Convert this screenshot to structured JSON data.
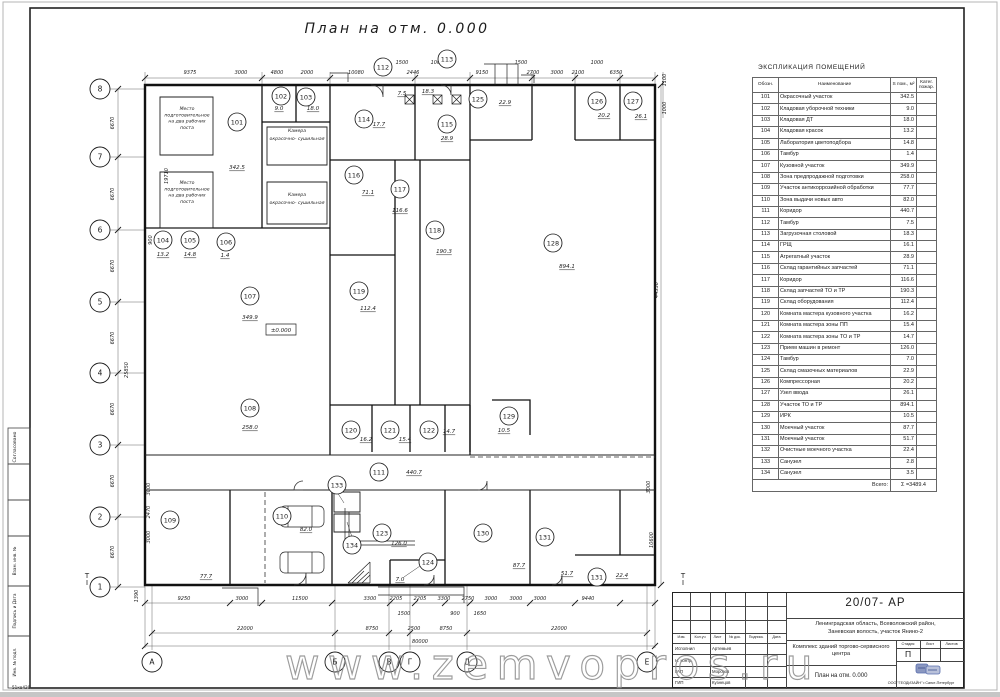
{
  "sheet": {
    "watermark": "www.zemvopros.ru",
    "corner_note": "51кв420"
  },
  "side_labels": {
    "approved": "Согласовано",
    "boxes": [
      "Взам. инв. №",
      "Подпись и Дата",
      "Инв. № подл."
    ]
  },
  "plan": {
    "title": "План на отм.  0.000",
    "level_mark": "±0.000",
    "axes": {
      "left": [
        [
          "8",
          89
        ],
        [
          "7",
          157
        ],
        [
          "6",
          230
        ],
        [
          "5",
          302
        ],
        [
          "4",
          373
        ],
        [
          "3",
          445
        ],
        [
          "2",
          517
        ],
        [
          "1",
          587
        ]
      ],
      "bottom": [
        [
          "А",
          152
        ],
        [
          "Б",
          335
        ],
        [
          "В",
          389
        ],
        [
          "Г",
          410
        ],
        [
          "Д",
          467
        ],
        [
          "Е",
          647
        ]
      ]
    },
    "dims": [
      [
        "9375",
        190,
        74,
        0
      ],
      [
        "3000",
        241,
        74,
        0
      ],
      [
        "4800",
        277,
        74,
        0
      ],
      [
        "2000",
        307,
        74,
        0
      ],
      [
        "10080",
        356,
        74,
        0
      ],
      [
        "2446",
        413,
        74,
        0
      ],
      [
        "9150",
        482,
        74,
        0
      ],
      [
        "2700",
        533,
        74,
        0
      ],
      [
        "3000",
        557,
        74,
        0
      ],
      [
        "2100",
        578,
        74,
        0
      ],
      [
        "6350",
        616,
        74,
        0
      ],
      [
        "1500",
        402,
        64,
        0
      ],
      [
        "1000",
        437,
        64,
        0
      ],
      [
        "1500",
        521,
        64,
        0
      ],
      [
        "1000",
        597,
        64,
        0
      ],
      [
        "9250",
        184,
        600,
        0
      ],
      [
        "3000",
        242,
        600,
        0
      ],
      [
        "11500",
        300,
        600,
        0
      ],
      [
        "3300",
        370,
        600,
        0
      ],
      [
        "2205",
        396,
        600,
        0
      ],
      [
        "2205",
        420,
        600,
        0
      ],
      [
        "3300",
        444,
        600,
        0
      ],
      [
        "2750",
        468,
        600,
        0
      ],
      [
        "3000",
        491,
        600,
        0
      ],
      [
        "3000",
        516,
        600,
        0
      ],
      [
        "3000",
        540,
        600,
        0
      ],
      [
        "9440",
        588,
        600,
        0
      ],
      [
        "1500",
        404,
        615,
        0
      ],
      [
        "900",
        455,
        615,
        0
      ],
      [
        "1650",
        480,
        615,
        0
      ],
      [
        "22000",
        245,
        630,
        0
      ],
      [
        "8750",
        372,
        630,
        0
      ],
      [
        "2500",
        414,
        630,
        0
      ],
      [
        "8750",
        446,
        630,
        0
      ],
      [
        "22000",
        559,
        630,
        0
      ],
      [
        "80000",
        420,
        643,
        0
      ],
      [
        "6670",
        114,
        123,
        1
      ],
      [
        "6670",
        114,
        194,
        1
      ],
      [
        "6670",
        114,
        266,
        1
      ],
      [
        "6670",
        114,
        338,
        1
      ],
      [
        "6670",
        114,
        409,
        1
      ],
      [
        "6670",
        114,
        481,
        1
      ],
      [
        "6670",
        114,
        552,
        1
      ],
      [
        "19710",
        168,
        176,
        1
      ],
      [
        "900",
        152,
        240,
        1
      ],
      [
        "25850",
        128,
        370,
        1
      ],
      [
        "3000",
        150,
        489,
        1
      ],
      [
        "2470",
        150,
        512,
        1
      ],
      [
        "3000",
        150,
        537,
        1
      ],
      [
        "1390",
        138,
        596,
        1
      ],
      [
        "1100",
        666,
        80,
        1
      ],
      [
        "1000",
        666,
        108,
        1
      ],
      [
        "44330",
        658,
        290,
        1
      ],
      [
        "3000",
        650,
        487,
        1
      ],
      [
        "10600",
        653,
        540,
        1
      ]
    ],
    "rooms": [
      [
        "101",
        237,
        122,
        "342.5",
        237,
        169
      ],
      [
        "102",
        281,
        96,
        "9.0",
        279,
        110
      ],
      [
        "103",
        306,
        97,
        "18.0",
        313,
        110
      ],
      [
        "104",
        163,
        240,
        "13.2",
        163,
        256
      ],
      [
        "105",
        190,
        240,
        "14.8",
        190,
        256
      ],
      [
        "106",
        226,
        242,
        "1.4",
        225,
        257
      ],
      [
        "107",
        250,
        296,
        "349.9",
        250,
        319
      ],
      [
        "108",
        250,
        408,
        "258.0",
        250,
        429
      ],
      [
        "109",
        170,
        520,
        "77.7",
        206,
        578
      ],
      [
        "110",
        282,
        516,
        "82.0",
        306,
        531
      ],
      [
        "111",
        379,
        472,
        "440.7",
        414,
        474
      ],
      [
        "112",
        383,
        67,
        "7.5",
        402,
        95
      ],
      [
        "113",
        447,
        59,
        "18.3",
        428,
        93
      ],
      [
        "114",
        364,
        119,
        "17.7",
        379,
        126
      ],
      [
        "115",
        447,
        124,
        "28.9",
        447,
        140
      ],
      [
        "116",
        354,
        175,
        "71.1",
        368,
        194
      ],
      [
        "117",
        400,
        189,
        "116.6",
        400,
        212
      ],
      [
        "118",
        435,
        230,
        "190.3",
        444,
        253
      ],
      [
        "119",
        359,
        291,
        "112.4",
        368,
        310
      ],
      [
        "120",
        351,
        430,
        "16.2",
        366,
        441
      ],
      [
        "121",
        390,
        430,
        "15.4",
        405,
        441
      ],
      [
        "122",
        429,
        430,
        "14.7",
        449,
        433
      ],
      [
        "123",
        382,
        533,
        "126.0",
        399,
        545
      ],
      [
        "124",
        428,
        562,
        "7.0",
        400,
        581
      ],
      [
        "125",
        478,
        99,
        "22.9",
        505,
        104
      ],
      [
        "126",
        597,
        101,
        "20.2",
        604,
        117
      ],
      [
        "127",
        633,
        101,
        "26.1",
        641,
        118
      ],
      [
        "128",
        553,
        243,
        "894.1",
        567,
        268
      ],
      [
        "129",
        509,
        416,
        "10.5",
        504,
        432
      ],
      [
        "130",
        483,
        533,
        "87.7",
        519,
        567
      ],
      [
        "131",
        545,
        537,
        "51.7",
        567,
        575
      ],
      [
        "131",
        597,
        577,
        "22.4",
        622,
        577
      ],
      [
        "133",
        337,
        485,
        "",
        0,
        0
      ],
      [
        "134",
        352,
        545,
        "",
        0,
        0
      ]
    ],
    "annotations": [
      {
        "x": 187,
        "y": 110,
        "lh": 6.3,
        "lines": [
          "Место",
          "подготовительное",
          "на  два  рабочих",
          "поста"
        ]
      },
      {
        "x": 187,
        "y": 184,
        "lh": 6.3,
        "lines": [
          "Место",
          "подготовительное",
          "на  два  рабочих",
          "поста"
        ]
      },
      {
        "x": 297,
        "y": 132,
        "lh": 8,
        "lines": [
          "Камера",
          "окрасочно- сушильная"
        ]
      },
      {
        "x": 297,
        "y": 196,
        "lh": 8,
        "lines": [
          "Камера",
          "окрасочно- сушильная"
        ]
      }
    ],
    "markers": [
      [
        "Т",
        87,
        578
      ],
      [
        "Т",
        683,
        578
      ]
    ]
  },
  "explication": {
    "title": "ЭКСПЛИКАЦИЯ ПОМЕЩЕНИЙ",
    "columns": [
      "Обозн.",
      "Наименование",
      "S пом., м²",
      "Катег. пожар."
    ],
    "rows": [
      [
        "101",
        "Окрасочный участок",
        "342.5"
      ],
      [
        "102",
        "Кладовая уборочной техники",
        "9.0"
      ],
      [
        "103",
        "Кладовая ДТ",
        "18.0"
      ],
      [
        "104",
        "Кладовая красок",
        "13.2"
      ],
      [
        "105",
        "Лаборатория цветоподбора",
        "14.8"
      ],
      [
        "106",
        "Тамбур",
        "1.4"
      ],
      [
        "107",
        "Кузовной участок",
        "349.9"
      ],
      [
        "108",
        "Зона предпродажной подготовки",
        "258.0"
      ],
      [
        "109",
        "Участок антикоррозийной обработки",
        "77.7"
      ],
      [
        "110",
        "Зона выдачи новых авто",
        "82.0"
      ],
      [
        "111",
        "Коридор",
        "440.7"
      ],
      [
        "112",
        "Тамбур",
        "7.5"
      ],
      [
        "113",
        "Загрузочная столовой",
        "18.3"
      ],
      [
        "114",
        "ГРЩ",
        "16.1"
      ],
      [
        "115",
        "Агрегатный участок",
        "28.9"
      ],
      [
        "116",
        "Склад гарантийных запчастей",
        "71.1"
      ],
      [
        "117",
        "Коридор",
        "116.6"
      ],
      [
        "118",
        "Склад запчастей ТО и ТР",
        "190.3"
      ],
      [
        "119",
        "Склад оборудования",
        "112.4"
      ],
      [
        "120",
        "Комната мастера кузовного участка",
        "16.2"
      ],
      [
        "121",
        "Комната мастера зоны ПП",
        "15.4"
      ],
      [
        "122",
        "Комната мастера зоны ТО и ТР",
        "14.7"
      ],
      [
        "123",
        "Прием машин в ремонт",
        "126.0"
      ],
      [
        "124",
        "Тамбур",
        "7.0"
      ],
      [
        "125",
        "Склад смазочных материалов",
        "22.9"
      ],
      [
        "126",
        "Компрессорная",
        "20.2"
      ],
      [
        "127",
        "Узел ввода",
        "26.1"
      ],
      [
        "128",
        "Участок ТО и ТР",
        "894.1"
      ],
      [
        "129",
        "ИРК",
        "10.5"
      ],
      [
        "130",
        "Моечный участок",
        "87.7"
      ],
      [
        "131",
        "Моечный участок",
        "51.7"
      ],
      [
        "132",
        "Очистные моечного участка",
        "22.4"
      ],
      [
        "133",
        "Санузел",
        "2.8"
      ],
      [
        "134",
        "Санузел",
        "3.5"
      ]
    ],
    "total_label": "Всего:",
    "total_value": "Σ =3489.4"
  },
  "title_block": {
    "code": "20/07- АР",
    "location_line1": "Ленинградская область, Всеволожский район,",
    "location_line2": "Заневская волость, участок Янино-2",
    "project": "Комплекс зданий торгово-сервисного центра",
    "drawing_title": "План на отм. 0.000",
    "stage_label": "Стадия",
    "sheet_label": "Лист",
    "sheets_label": "Листов",
    "stage_value": "П",
    "company": "ООО \"ГЕОДИЗАЙН\" г.Санкт-Петербург",
    "header_cols": [
      "Изм.",
      "Кол.уч",
      "Лист",
      "№ док.",
      "Подпись",
      "Дата"
    ],
    "roles": [
      {
        "role": "Исполнил",
        "name": "Артемьев"
      },
      {
        "role": "Н. контр.",
        "name": ""
      },
      {
        "role": "ГАП",
        "name": "Морозов"
      },
      {
        "role": "ГИП",
        "name": "Кузнецов"
      }
    ]
  }
}
